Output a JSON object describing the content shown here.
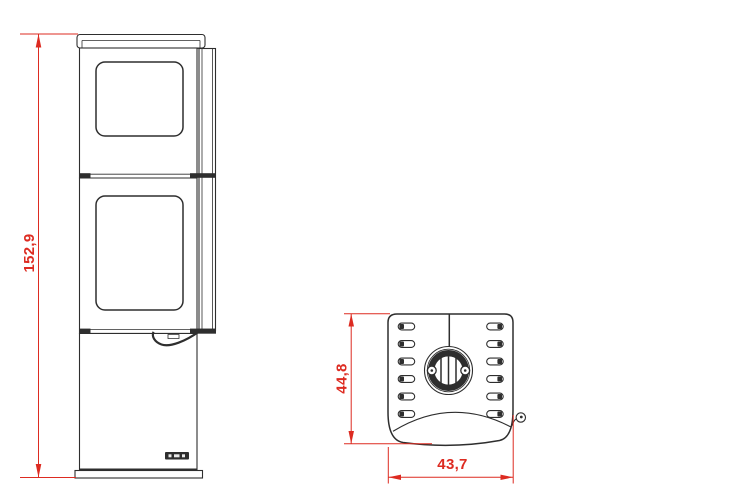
{
  "dimensions": {
    "front_height": "152,9",
    "top_depth": "44,8",
    "top_width": "43,7"
  },
  "colors": {
    "line": "#2e2e2e",
    "dimension": "#dd2b21",
    "background": "#ffffff"
  }
}
